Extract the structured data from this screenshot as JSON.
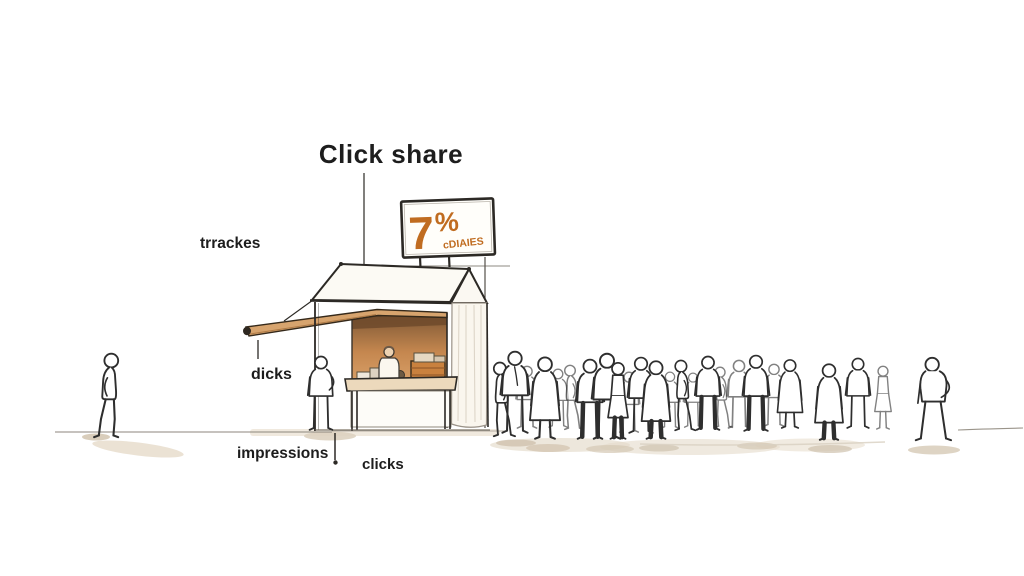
{
  "scene": {
    "title": "Click share",
    "sign": {
      "number": "7",
      "percent_symbol": "%",
      "caption": "cDIAIES"
    },
    "labels": {
      "trackers": "trrackes",
      "awning_clicks": "dicks",
      "impressions": "impressions",
      "clicks": "clicks"
    },
    "colors": {
      "accent_orange": "#c06c20",
      "awning_tan": "#d7a46e",
      "interior_brown": "#c5874f",
      "ink": "#2c2925",
      "shadow_tan": "#e4dac9"
    },
    "figures": [
      {
        "x": 527,
        "y": 429,
        "h": 64,
        "v": "front",
        "faint": 1
      },
      {
        "x": 558,
        "y": 428,
        "h": 60,
        "v": "front",
        "faint": 1
      },
      {
        "x": 571,
        "y": 430,
        "h": 66,
        "v": "side",
        "flip": 1,
        "faint": 1
      },
      {
        "x": 629,
        "y": 433,
        "h": 62,
        "v": "front",
        "faint": 1
      },
      {
        "x": 670,
        "y": 429,
        "h": 58,
        "v": "front",
        "faint": 1
      },
      {
        "x": 693,
        "y": 428,
        "h": 56,
        "v": "front",
        "faint": 1
      },
      {
        "x": 721,
        "y": 428,
        "h": 62,
        "v": "side",
        "flip": 1,
        "faint": 1
      },
      {
        "x": 739,
        "y": 429,
        "h": 70,
        "v": "front",
        "faint": 1
      },
      {
        "x": 774,
        "y": 427,
        "h": 64,
        "v": "front",
        "faint": 1
      },
      {
        "x": 883,
        "y": 430,
        "h": 66,
        "v": "skirt",
        "faint": 1
      },
      {
        "x": 501,
        "y": 437,
        "h": 76,
        "v": "side",
        "flip": 1
      },
      {
        "x": 515,
        "y": 434,
        "h": 84,
        "v": "tie"
      },
      {
        "x": 545,
        "y": 440,
        "h": 86,
        "v": "coat"
      },
      {
        "x": 590,
        "y": 440,
        "h": 82,
        "v": "front",
        "dark": 1
      },
      {
        "x": 607,
        "y": 440,
        "h": 88,
        "v": "front"
      },
      {
        "x": 618,
        "y": 440,
        "h": 80,
        "v": "skirt",
        "dark": 1
      },
      {
        "x": 641,
        "y": 434,
        "h": 78,
        "v": "front"
      },
      {
        "x": 656,
        "y": 440,
        "h": 82,
        "v": "coat",
        "dark": 1
      },
      {
        "x": 682,
        "y": 431,
        "h": 72,
        "v": "side",
        "flip": 1
      },
      {
        "x": 708,
        "y": 431,
        "h": 76,
        "v": "front",
        "dark": 1
      },
      {
        "x": 756,
        "y": 432,
        "h": 78,
        "v": "front",
        "dark": 1
      },
      {
        "x": 790,
        "y": 429,
        "h": 72,
        "v": "coat"
      },
      {
        "x": 829,
        "y": 441,
        "h": 80,
        "v": "coat",
        "dark": 1
      },
      {
        "x": 858,
        "y": 429,
        "h": 72,
        "v": "front"
      },
      {
        "x": 933,
        "y": 441,
        "h": 84,
        "v": "akimbo"
      },
      {
        "x": 110,
        "y": 438,
        "h": 86,
        "v": "side"
      },
      {
        "x": 321,
        "y": 431,
        "h": 76,
        "v": "back"
      }
    ]
  }
}
